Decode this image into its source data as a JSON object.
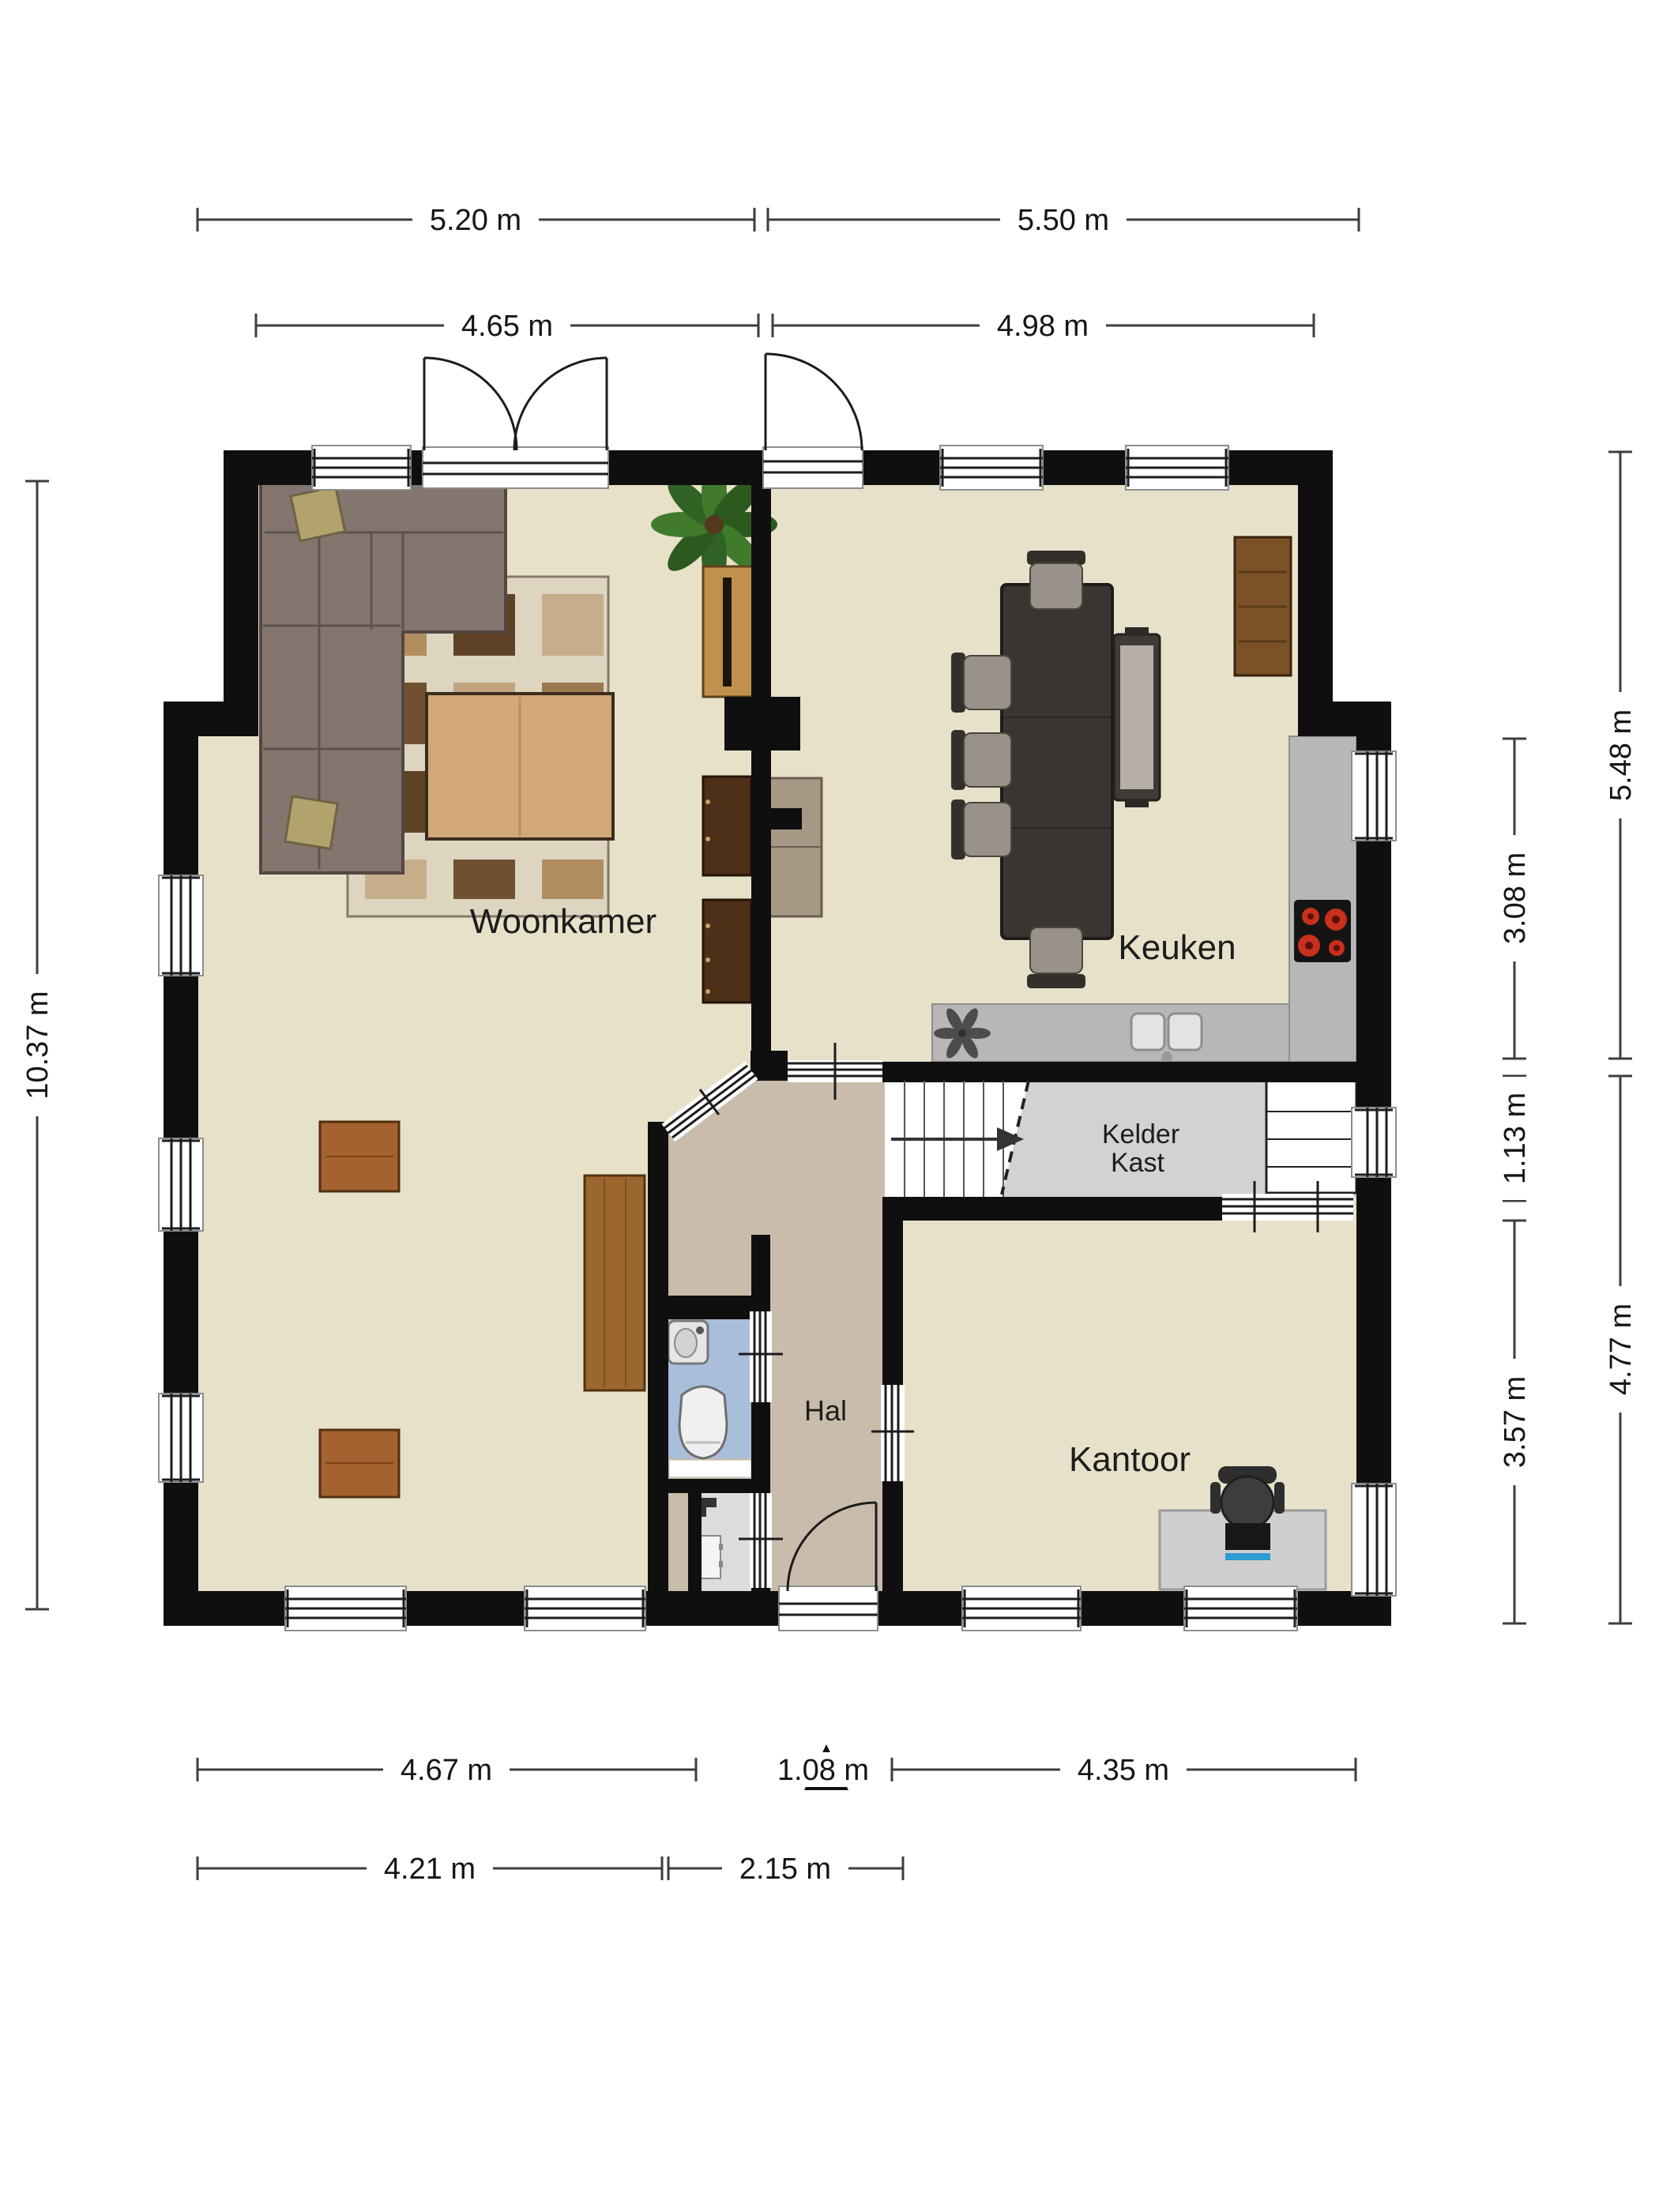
{
  "plan": {
    "type": "residential-floor-plan",
    "language": "nl"
  },
  "rooms": {
    "woonkamer": "Woonkamer",
    "keuken": "Keuken",
    "kelder_kast_line1": "Kelder",
    "kelder_kast_line2": "Kast",
    "hal": "Hal",
    "kantoor": "Kantoor"
  },
  "dimensions": {
    "top_row1": [
      "5.20 m",
      "5.50 m"
    ],
    "top_row2": [
      "4.65 m",
      "4.98 m"
    ],
    "left": [
      "10.37 m"
    ],
    "right_inner": [
      "3.08 m",
      "1.13 m",
      "3.57 m"
    ],
    "right_outer": [
      "5.48 m",
      "4.77 m"
    ],
    "bottom_row1": [
      "4.67 m",
      "1.08 m",
      "4.35 m"
    ],
    "bottom_row2": [
      "4.21 m",
      "2.15 m"
    ]
  },
  "icons": {
    "entrance_arrow": "triangle-up",
    "stairs_direction": "arrow-right",
    "ventilation_fan": "fan-rotor",
    "door_swings": "quarter-arc",
    "cooktop_burners": "four-red-circles"
  },
  "colors": {
    "wall": "#0f0f0f",
    "floor_main": "#e8e1ca",
    "floor_hal": "#c9bcab",
    "floor_toilet": "#a9bedb",
    "floor_closet": "#dcdcdc",
    "floor_kelder": "#d2d2d2",
    "floor_stairs": "#ffffff",
    "counter": "#b7b7b7",
    "cooktop_burner": "#c6301c",
    "dim_line": "#3d3d3d",
    "label_text": "#1c1c1c"
  }
}
